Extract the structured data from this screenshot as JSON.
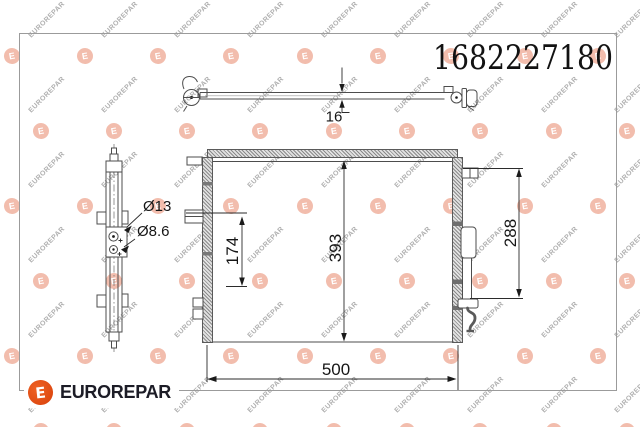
{
  "part_number": "1682227180",
  "brand": {
    "name": "EUROREPAR",
    "logo_letter": "E",
    "logo_color": "#e2490f",
    "name_color": "#1c1c26"
  },
  "watermark": {
    "text": "EUROREPAR",
    "logo_letter": "E"
  },
  "dimensions": {
    "overall_width": "500",
    "core_height": "393",
    "right_height": "288",
    "left_height": "174",
    "depth": "16",
    "large_port": "Ø13",
    "small_port": "Ø8.6"
  }
}
